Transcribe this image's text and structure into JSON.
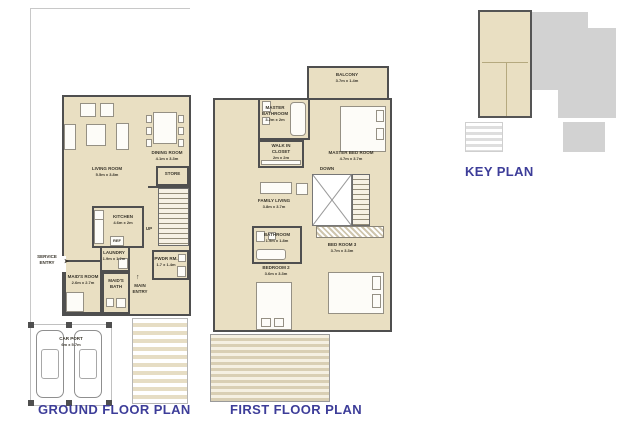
{
  "titles": {
    "ground": "GROUND FLOOR PLAN",
    "first": "FIRST FLOOR PLAN",
    "key": "KEY PLAN"
  },
  "icons": {
    "up_arrow": "↑",
    "right_arrow": "➤"
  },
  "colors": {
    "floor": "#e9dfc2",
    "wall": "#4f4f4f",
    "title_blue": "#3d3d99",
    "keyplan_gray": "#d2d2d2"
  },
  "ground_floor": {
    "living_room": {
      "name": "LIVING ROOM",
      "dims": "5.5m x 3.8m"
    },
    "dining_room": {
      "name": "DINING ROOM",
      "dims": "4.1m x 3.3m"
    },
    "store": {
      "name": "STORE"
    },
    "up": {
      "name": "UP"
    },
    "kitchen": {
      "name": "KITCHEN",
      "dims": "4.6m x 2m"
    },
    "ref": {
      "name": "REF"
    },
    "laundry": {
      "name": "LAUNDRY",
      "dims": "1.9m x 1.2m"
    },
    "powder_room": {
      "name": "PWDR RM.",
      "dims": "1.7 x 1.4m"
    },
    "service_entry": {
      "name": "SERVICE ENTRY"
    },
    "maids_room": {
      "name": "MAID'S ROOM",
      "dims": "2.6m x 2.7m"
    },
    "maids_bath": {
      "name": "MAID'S BATH"
    },
    "main_entry": {
      "name": "MAIN ENTRY"
    },
    "car_port": {
      "name": "CAR PORT",
      "dims": "6m x 5.7m"
    }
  },
  "first_floor": {
    "balcony": {
      "name": "BALCONY",
      "dims": "3.7m x 1.4m"
    },
    "master_bathroom": {
      "name": "MASTER BATHROOM",
      "dims": "3.2m x 2m"
    },
    "walk_in_closet": {
      "name": "WALK IN CLOSET",
      "dims": "2m x 2m"
    },
    "master_bedroom": {
      "name": "MASTER BED ROOM",
      "dims": "4.7m x 3.7m"
    },
    "down": {
      "name": "DOWN"
    },
    "family_living": {
      "name": "FAMILY LIVING",
      "dims": "3.8m x 3.7m"
    },
    "bathroom": {
      "name": "BATHROOM",
      "dims": "1.9m x 1.8m"
    },
    "bedroom_2": {
      "name": "BEDROOM 2",
      "dims": "3.6m x 3.3m"
    },
    "bedroom_3": {
      "name": "BED ROOM 3",
      "dims": "3.7m x 3.3m"
    }
  }
}
